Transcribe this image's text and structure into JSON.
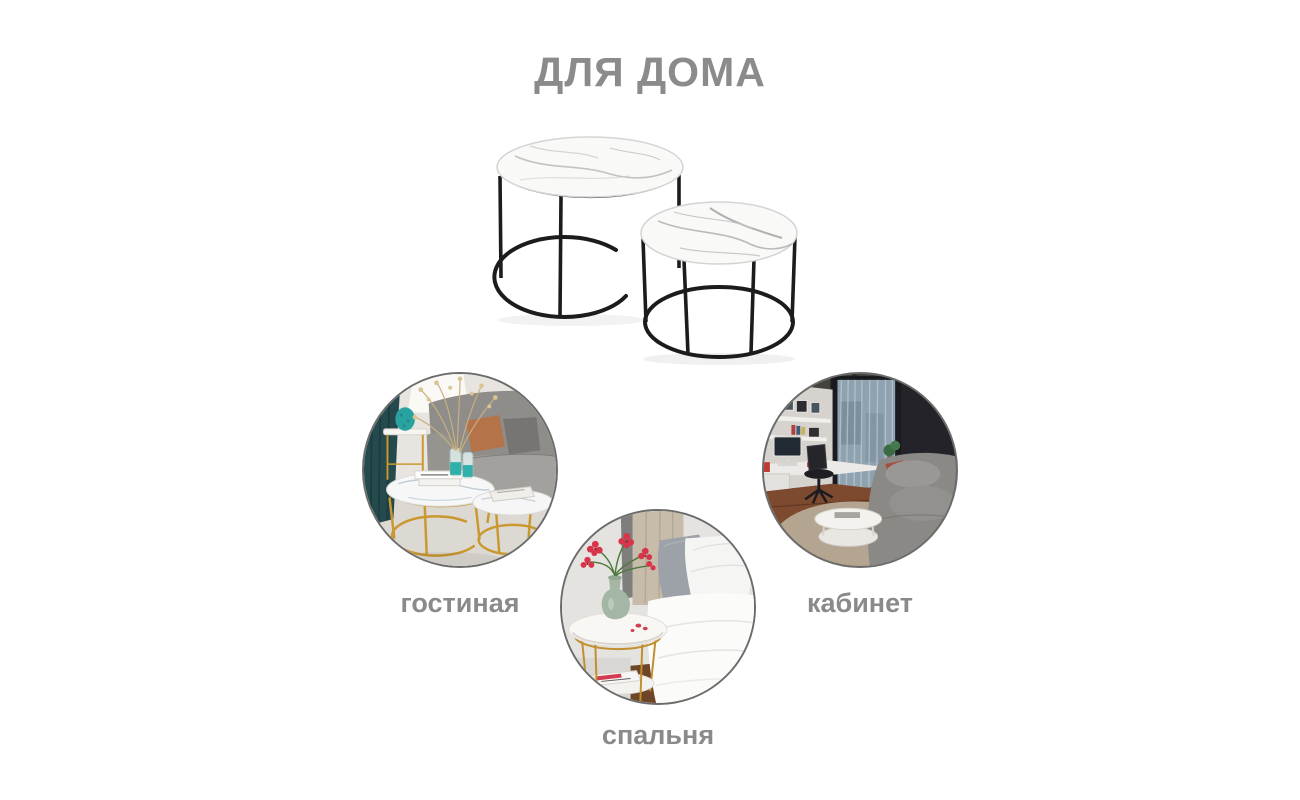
{
  "page": {
    "title": "ДЛЯ ДОМА"
  },
  "product": {
    "kind": "nesting-coffee-tables",
    "tables_visible": 2,
    "top_material": "white-marble",
    "frame_color_hex": "#1c1c1c"
  },
  "categories": [
    {
      "id": "living-room",
      "label": "гостиная"
    },
    {
      "id": "office",
      "label": "кабинет"
    },
    {
      "id": "bedroom",
      "label": "спальня"
    }
  ],
  "colors": {
    "background": "#ffffff",
    "title_text": "#8b8b8b",
    "label_text": "#8a8a8a",
    "circle_border": "#6b6b6b",
    "product_frame": "#1c1c1c",
    "marble": "#f8f8f8",
    "gold_accent": "#c9982f",
    "teal_accent": "#2aa3a0",
    "flower_red": "#d0344a",
    "vase_green": "#a3b7a4"
  }
}
